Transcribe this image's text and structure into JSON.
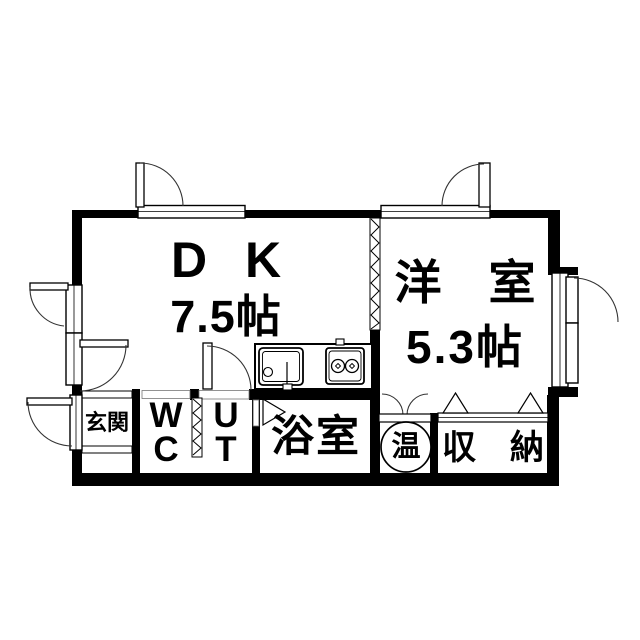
{
  "colors": {
    "wall": "#000000",
    "floor": "#ffffff",
    "line": "#2a2a2a"
  },
  "rooms": {
    "dk": {
      "label": "D K",
      "size": "7.5帖"
    },
    "western": {
      "label": "洋　室",
      "size": "5.3帖"
    },
    "genkan": {
      "label": "玄関"
    },
    "wc": {
      "label": "W\nC"
    },
    "ut": {
      "label": "U\nT"
    },
    "bath": {
      "label": "浴室"
    },
    "water_heater": {
      "label": "温"
    },
    "storage": {
      "label": "収　納"
    }
  }
}
